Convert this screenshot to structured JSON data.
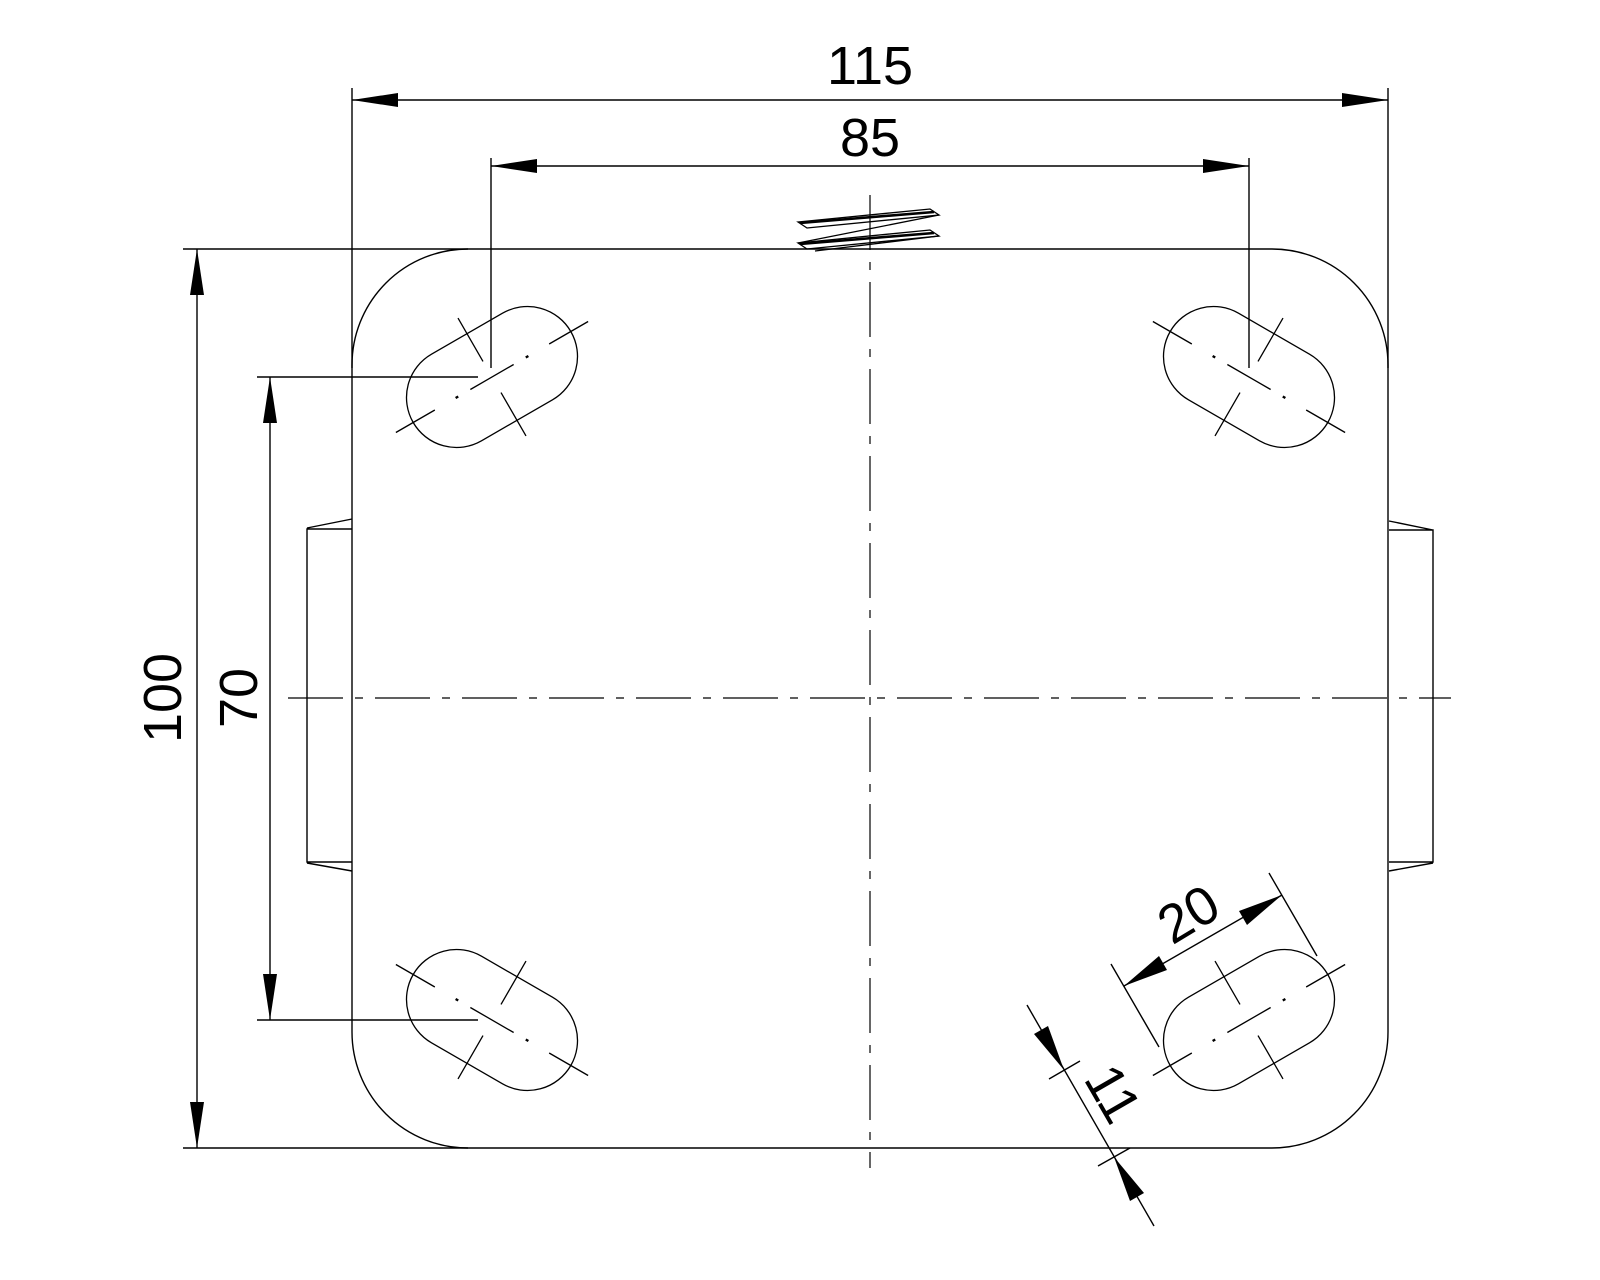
{
  "drawing": {
    "kind": "engineering-drawing-plan-view",
    "subject": "mounting-plate-with-slotted-holes",
    "background_color": "#ffffff",
    "line_color": "#000000",
    "dimensions": {
      "overall_width": "115",
      "hole_spacing_width": "85",
      "overall_depth": "100",
      "hole_spacing_depth": "70",
      "slot_length": "20",
      "slot_width": "11"
    }
  }
}
